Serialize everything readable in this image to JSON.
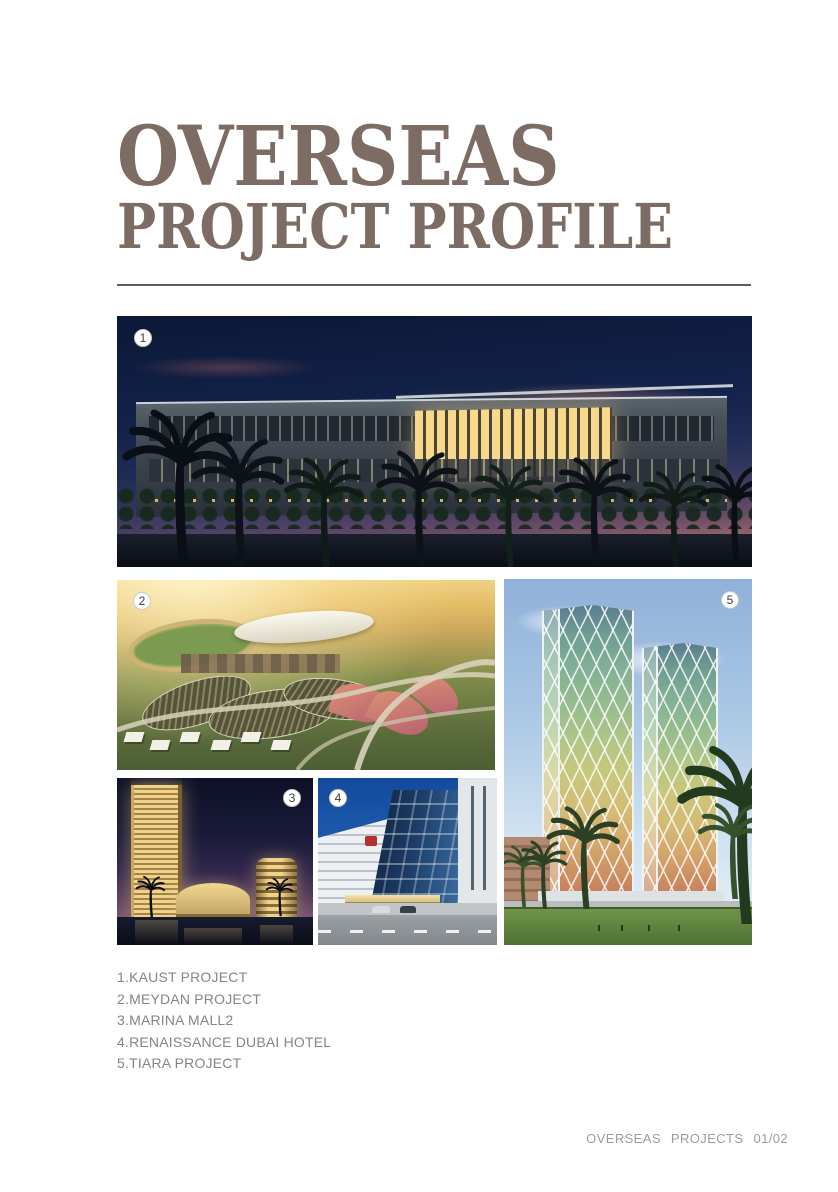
{
  "page": {
    "title_line1": "OVERSEAS",
    "title_line2": "PROJECT PROFILE",
    "footer": "OVERSEAS  PROJECTS  01/02"
  },
  "photos": [
    {
      "badge": "1",
      "name": "KAUST PROJECT"
    },
    {
      "badge": "2",
      "name": "MEYDAN PROJECT"
    },
    {
      "badge": "3",
      "name": "MARINA MALL2"
    },
    {
      "badge": "4",
      "name": "RENAISSANCE DUBAI HOTEL"
    },
    {
      "badge": "5",
      "name": "TIARA PROJECT"
    }
  ],
  "captions": [
    "1.KAUST PROJECT",
    "2.MEYDAN PROJECT",
    "3.MARINA MALL2",
    "4.RENAISSANCE DUBAI HOTEL",
    "5.TIARA PROJECT"
  ],
  "colors": {
    "title": "#7c6c63",
    "caption_text": "#858585",
    "footer_text": "#9c9c9c",
    "rule": "#5d5d5d",
    "badge_bg": "#ffffff",
    "badge_text": "#3d3d3d"
  }
}
